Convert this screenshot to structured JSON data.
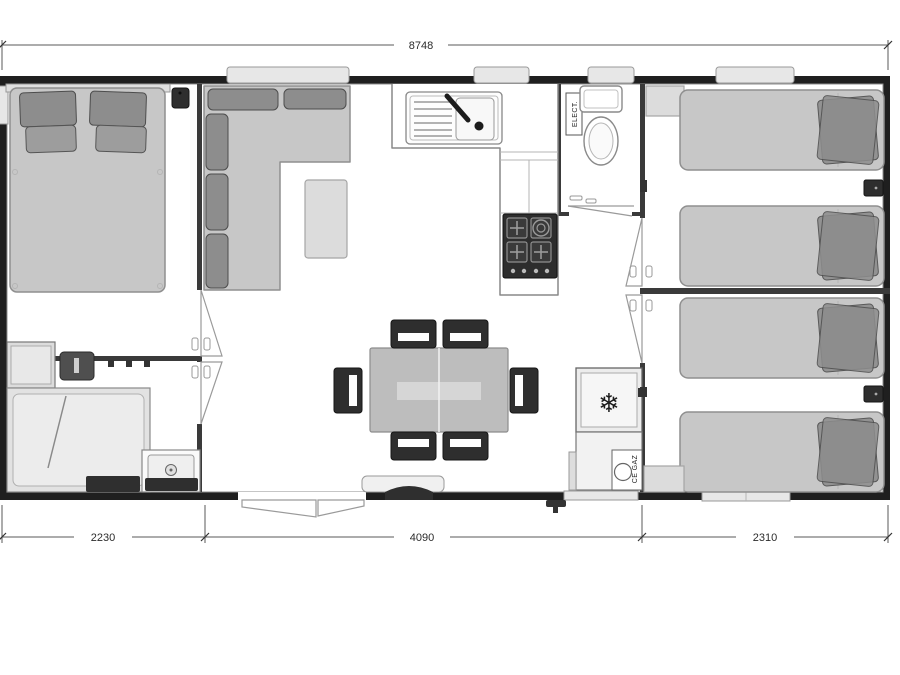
{
  "dimensions": {
    "overall_width": "8748",
    "bottom_segments": [
      "2230",
      "4090",
      "2310"
    ]
  },
  "labels": {
    "electrical_box": "ELECT.",
    "gas_locker": "CE GAZ"
  },
  "icons": {
    "snowflake_glyph": "❄"
  },
  "colors": {
    "wall": "#1f1f1f",
    "interior_wall": "#3a3a3a",
    "floor": "#ffffff",
    "furniture_light": "#c7c7c7",
    "furniture_mid": "#8d8d8d",
    "furniture_dark": "#2e2e2e",
    "window": "#e7e7e7",
    "dimension_text": "#2b2b2b"
  }
}
